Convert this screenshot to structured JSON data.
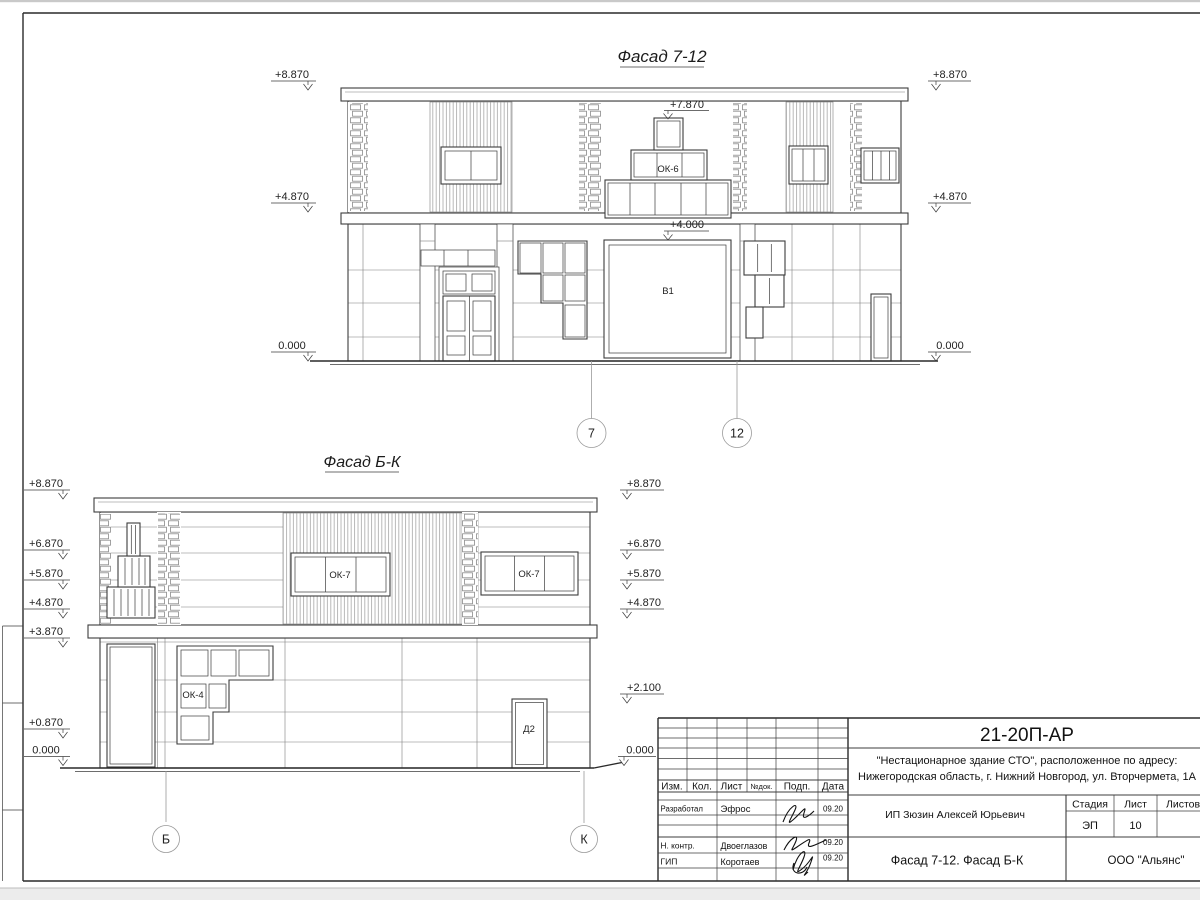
{
  "facade_top": {
    "title": "Фасад 7-12",
    "elevation_marks": {
      "left": [
        "+8.870",
        "+4.870",
        "0.000"
      ],
      "right": [
        "+8.870",
        "+4.870",
        "0.000"
      ],
      "ok6_top": "+7.870",
      "gate_top": "+4.000"
    },
    "labels": {
      "stepped_window": "ОК-6",
      "gate": "В1"
    },
    "axes": [
      "7",
      "12"
    ]
  },
  "facade_bottom": {
    "title": "Фасад Б-К",
    "elevation_marks": {
      "left": [
        "+8.870",
        "+6.870",
        "+5.870",
        "+4.870",
        "+3.870",
        "+0.870",
        "0.000"
      ],
      "right": [
        "+8.870",
        "+6.870",
        "+5.870",
        "+4.870",
        "+2.100",
        "0.000"
      ]
    },
    "labels": {
      "window_left": "ОК-7",
      "window_right": "ОК-7",
      "stepped_window": "ОК-4",
      "door": "Д2"
    },
    "axes": [
      "Б",
      "К"
    ]
  },
  "title_block": {
    "doc_number": "21-20П-АР",
    "project_address_line1": "\"Нестационарное здание СТО\", расположенное по адресу:",
    "project_address_line2": "Нижегородская область, г. Нижний Новгород, ул. Вторчермета, 1А",
    "client": "ИП Зюзин Алексей Юрьевич",
    "drawing_title": "Фасад 7-12. Фасад Б-К",
    "company": "ООО \"Альянс\"",
    "stage_label": "Стадия",
    "sheet_label": "Лист",
    "sheets_label": "Листов",
    "stage_value": "ЭП",
    "sheet_value": "10",
    "columns": [
      "Изм.",
      "Кол.",
      "Лист",
      "№док.",
      "Подп.",
      "Дата"
    ],
    "signatories": [
      {
        "role": "Разработал",
        "name": "Эфрос",
        "date": "09.20"
      },
      {
        "role": "Н. контр.",
        "name": "Двоеглазов",
        "date": "09.20"
      },
      {
        "role": "ГИП",
        "name": "Коротаев",
        "date": "09.20"
      }
    ]
  }
}
